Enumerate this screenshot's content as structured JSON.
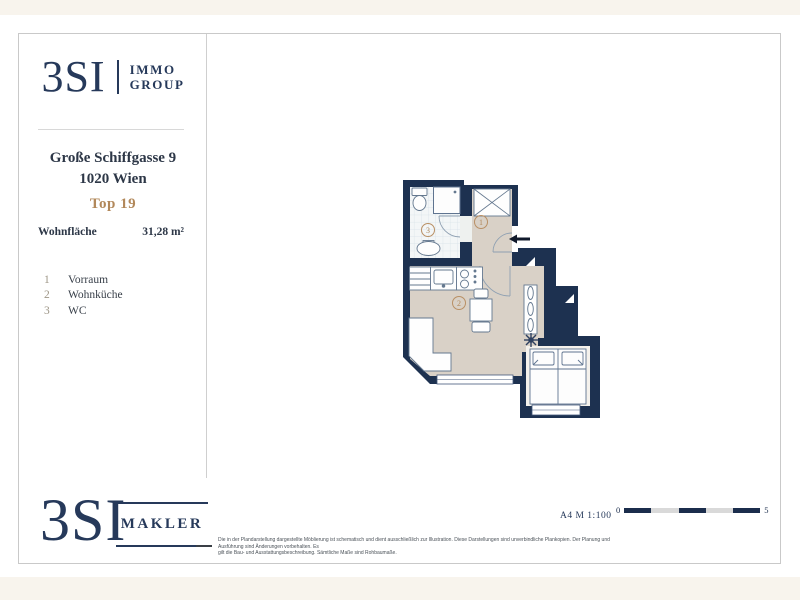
{
  "brand": {
    "name": "3SI",
    "division_top": "IMMO",
    "division_bottom": "GROUP",
    "footer_division": "MAKLER"
  },
  "property": {
    "street": "Große Schiffgasse 9",
    "city": "1020 Wien",
    "unit": "Top 19",
    "area_label": "Wohnfläche",
    "area_value": "31,28 m²"
  },
  "legend": {
    "items": [
      {
        "no": "1",
        "name": "Vorraum"
      },
      {
        "no": "2",
        "name": "Wohnküche"
      },
      {
        "no": "3",
        "name": "WC"
      }
    ]
  },
  "plan": {
    "room_labels": {
      "vorraum": "1",
      "wohnkueche": "2",
      "wc": "3"
    }
  },
  "footer": {
    "format_scale": "A4 M 1:100",
    "scale_zero": "0",
    "scale_five": "5",
    "disclaimer_line1": "Die in der Plandarstellung dargestellte Möblierung ist schematisch und dient ausschließlich zur Illustration. Diese Darstellungen sind unverbindliche Plankopien. Der Planung und Ausführung sind Änderungen vorbehalten. Es",
    "disclaimer_line2": "gilt die Bau- und Ausstattungsbeschreibung. Sämtliche Maße sind Rohbaumaße."
  },
  "colors": {
    "navy": "#26395a",
    "wall": "#1d3150",
    "accent_tan": "#b2885a",
    "floor_beige": "#d9d1c7",
    "cream": "#f8f4ed"
  }
}
